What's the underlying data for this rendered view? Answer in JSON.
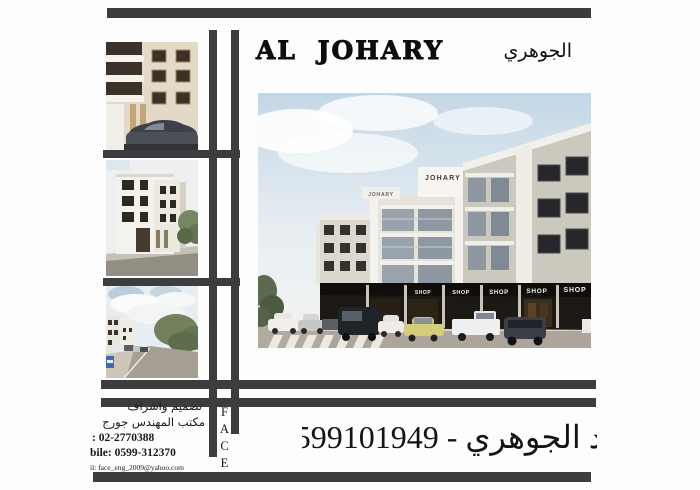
{
  "header": {
    "title_en": "AL JOHARY",
    "title_ar": "الجوهري"
  },
  "building": {
    "sign_primary": "JOHARY",
    "sign_secondary": "JOHARY",
    "shop_labels": [
      "SHOP",
      "SHOP",
      "SHOP",
      "SHOP",
      "SHOP"
    ]
  },
  "face_column": {
    "letters": [
      "F",
      "A",
      "C",
      "E"
    ]
  },
  "contact": {
    "design_line": "تصميم واشراف",
    "office_line": "مكتب المهندس جورج",
    "tel_line": ": 02-2770388",
    "mobile_line": "bile: 0599-312370",
    "email_line": "il: face_eng_2009@yahoo.com"
  },
  "footer": {
    "owner_phone": "د الجوهري - 0599101949"
  },
  "colors": {
    "frame_bar": "#3d3d3f",
    "shop_band": "#17130f",
    "sky_top": "#c3d7e6"
  }
}
